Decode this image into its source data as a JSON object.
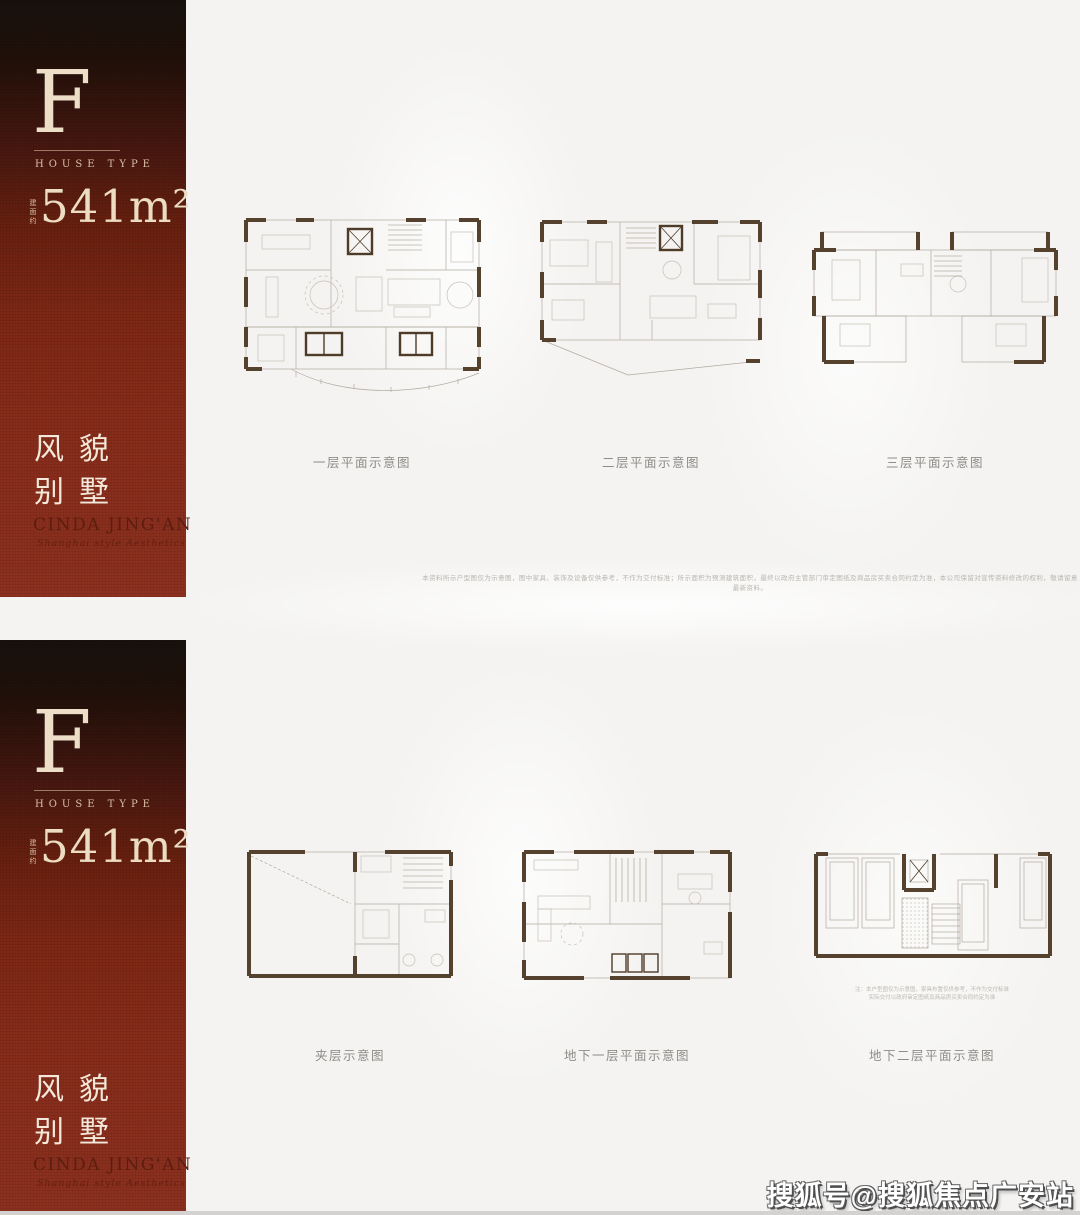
{
  "colors": {
    "sidebar_red": "#8c3020",
    "sidebar_dark": "#17110d",
    "cream": "#ecdcc2",
    "wall_brown": "#55422e",
    "plan_line_gray": "#b2aba1",
    "caption_gray": "#8d8c88"
  },
  "watermark": "搜狐号@搜狐焦点广安站",
  "panels": [
    {
      "sidebar": {
        "letter": "F",
        "letter_caption": "HOUSE TYPE",
        "area_note": "建面约",
        "area": "541m²",
        "title_line1": "风貌",
        "title_line2": "别墅",
        "brand": "CINDA JING'AN",
        "brand_tagline": "Shanghai style Aesthetics"
      },
      "plan_labels": [
        "一层平面示意图",
        "二层平面示意图",
        "三层平面示意图"
      ],
      "disclaimer": "本资料所示户型图仅为示意图，图中家具、装饰及设备仅供参考，不作为交付标准；所示面积为预测建筑面积，最终以政府主管部门审定图纸及商品房买卖合同约定为准，本公司保留对宣传资料修改的权利，敬请留意最新资料。"
    },
    {
      "sidebar": {
        "letter": "F",
        "letter_caption": "HOUSE TYPE",
        "area_note": "建面约",
        "area": "541m²",
        "title_line1": "风貌",
        "title_line2": "别墅",
        "brand": "CINDA JING'AN",
        "brand_tagline": "Shanghai style Aesthetics"
      },
      "plan_labels": [
        "夹层示意图",
        "地下一层平面示意图",
        "地下二层平面示意图"
      ],
      "plan_note_line1": "注：本户型图仅为示意图，家具布置仅供参考，不作为交付标准",
      "plan_note_line2": "实际交付以政府审定图纸及商品房买卖合同约定为准"
    }
  ]
}
